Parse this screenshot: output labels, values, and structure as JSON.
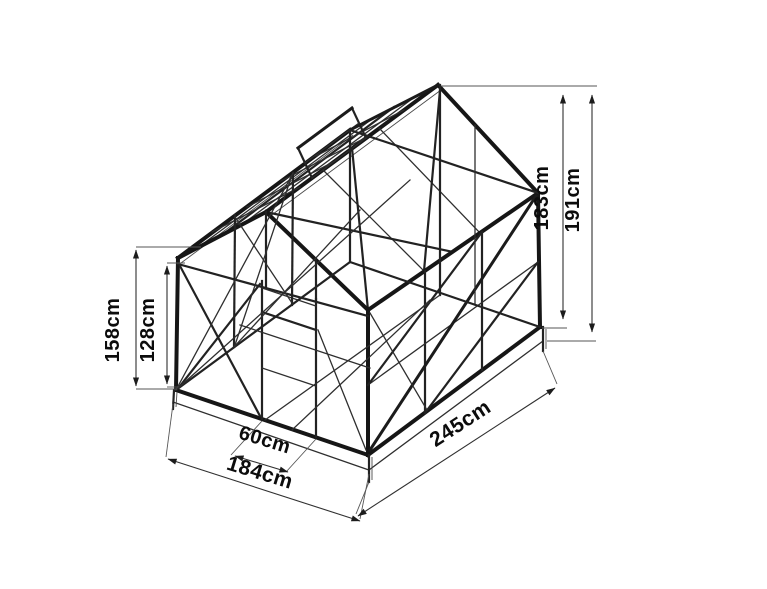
{
  "canvas": {
    "width": 767,
    "height": 589,
    "background": "#ffffff",
    "line_color": "#161616",
    "text_color": "#0c0c0c"
  },
  "diagram": {
    "kind": "isometric wireframe line drawing",
    "subject": "greenhouse-frame"
  },
  "dimensions": [
    {
      "id": "left-outer-height",
      "label": "158cm",
      "orientation": "vertical"
    },
    {
      "id": "left-inner-height",
      "label": "128cm",
      "orientation": "vertical"
    },
    {
      "id": "right-inner-height",
      "label": "183cm",
      "orientation": "vertical"
    },
    {
      "id": "right-outer-height",
      "label": "191cm",
      "orientation": "vertical"
    },
    {
      "id": "door-width",
      "label": "60cm",
      "orientation": "along-front-base"
    },
    {
      "id": "front-width",
      "label": "184cm",
      "orientation": "along-front-base"
    },
    {
      "id": "side-depth",
      "label": "245cm",
      "orientation": "along-side-base"
    }
  ]
}
